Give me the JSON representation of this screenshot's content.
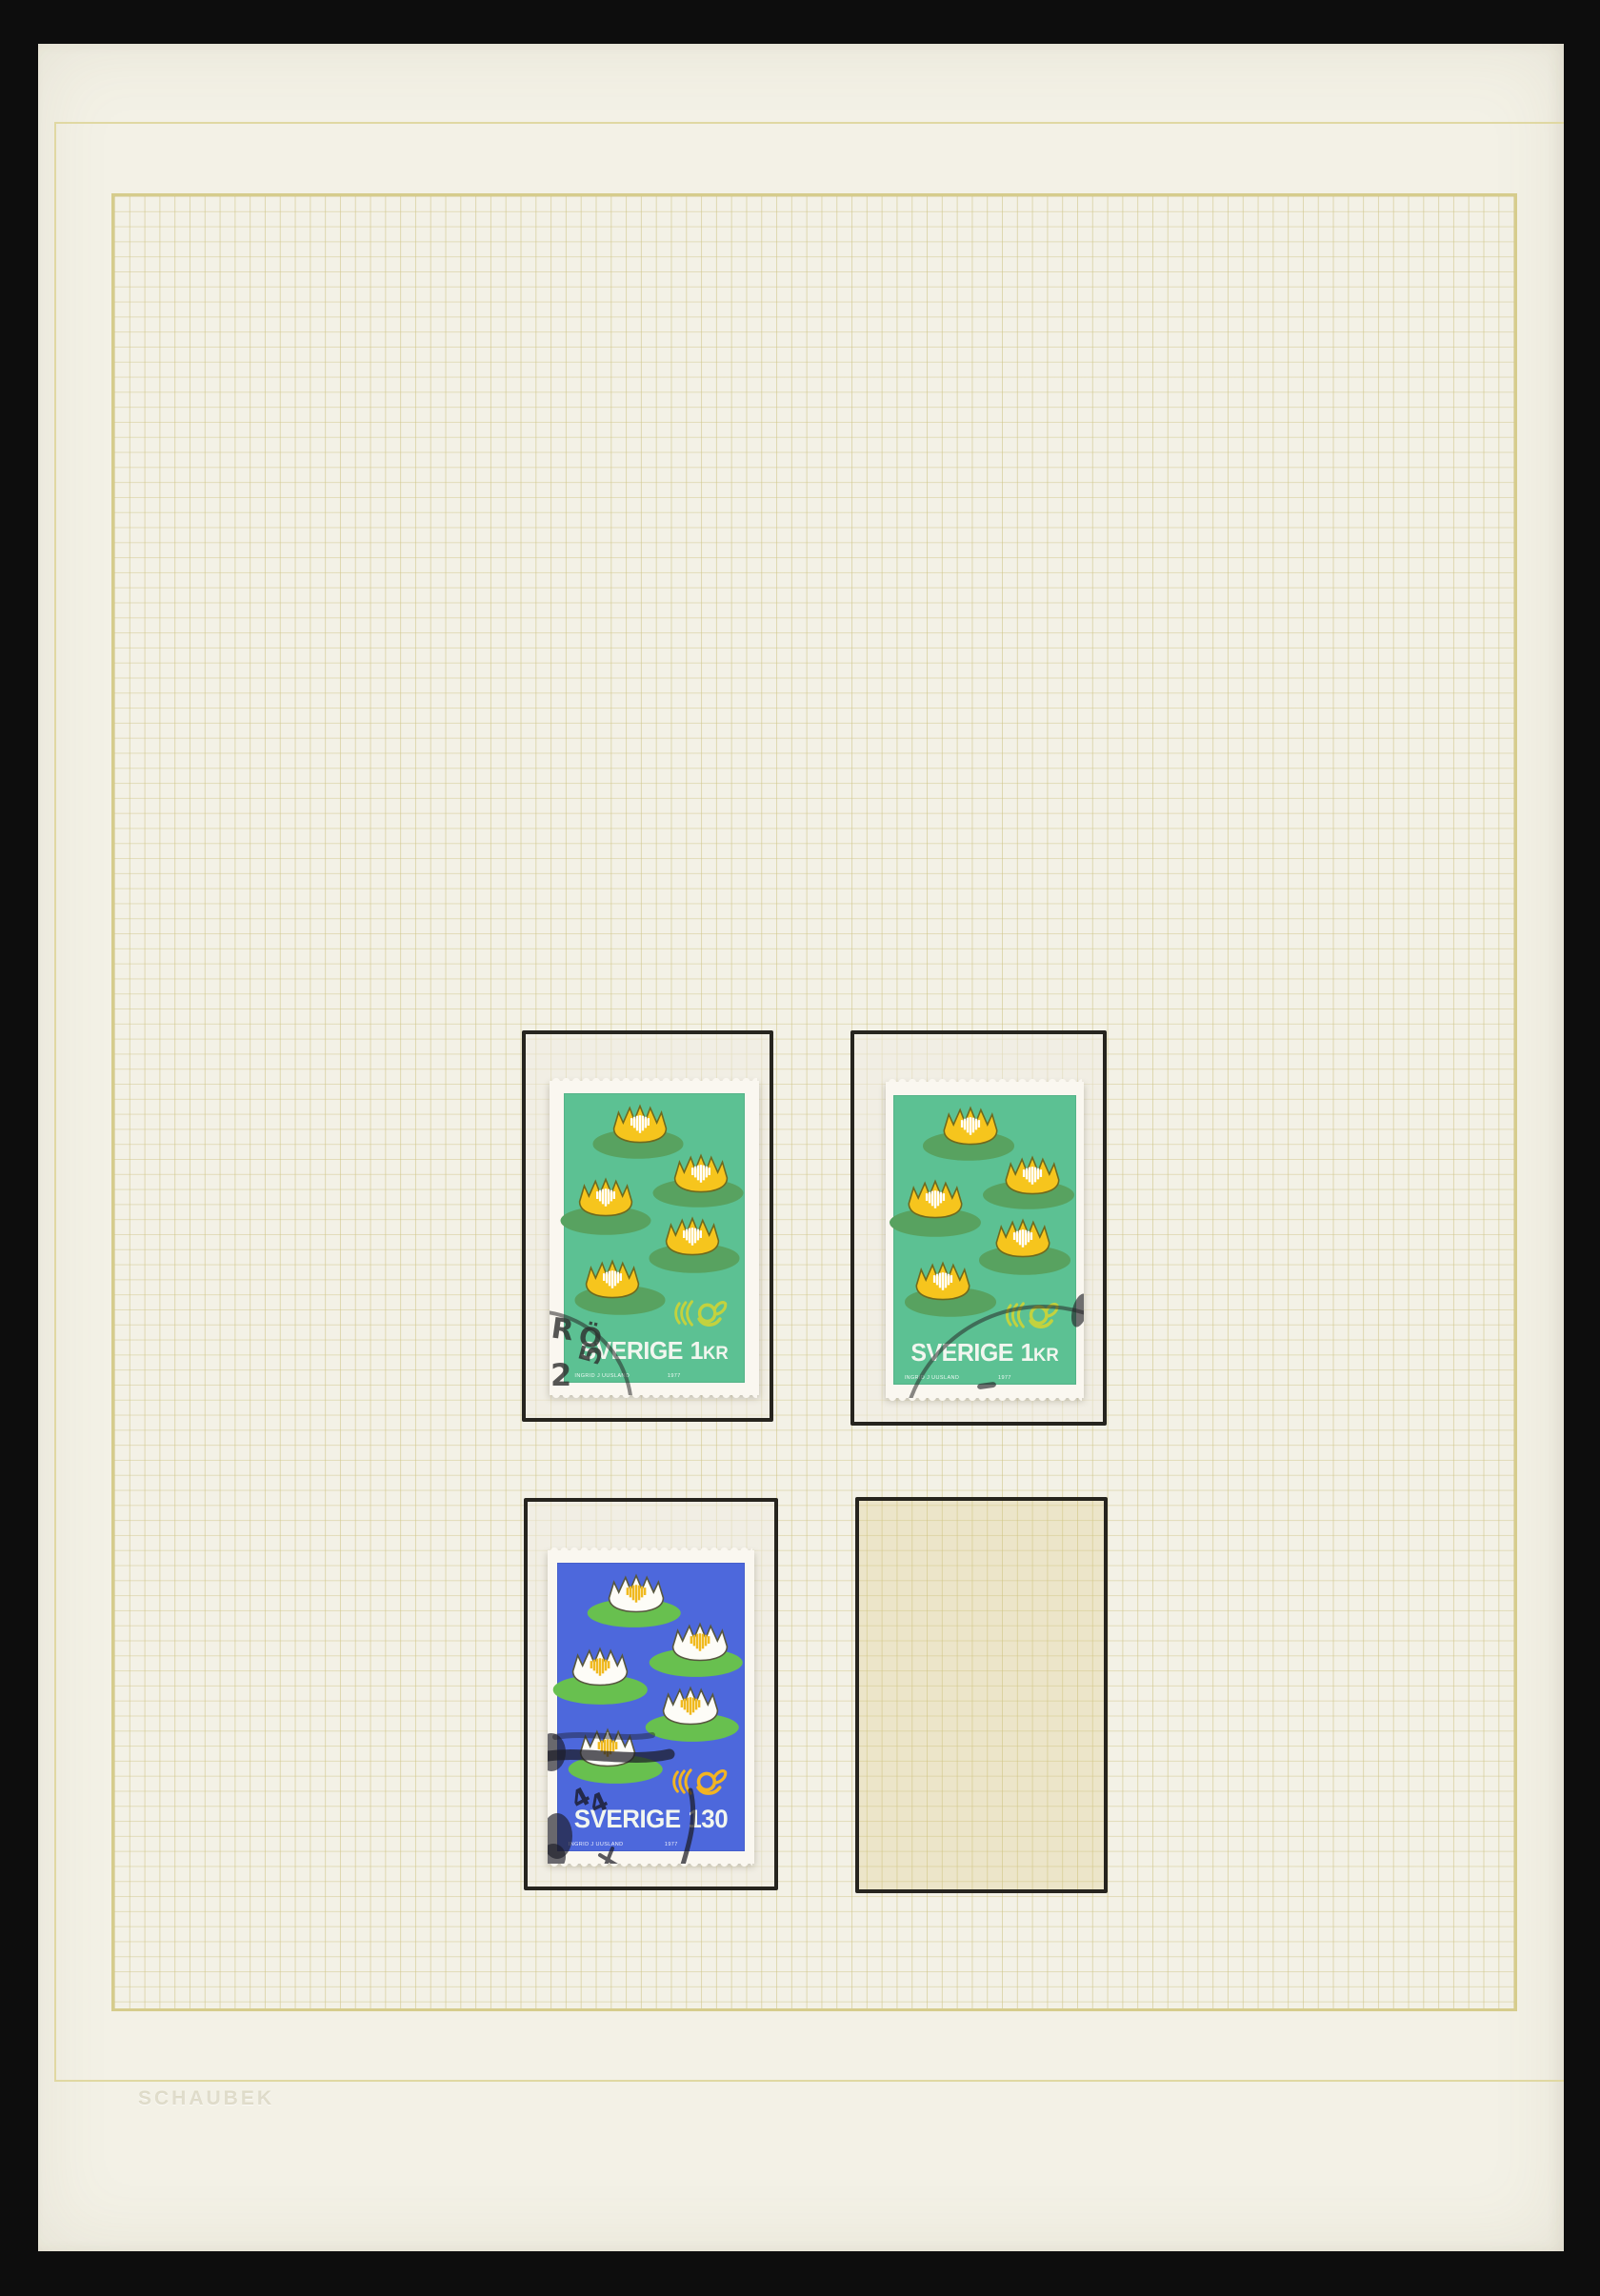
{
  "page": {
    "type": "stamp album page",
    "album_brand_emboss": "SCHAUBEK",
    "paper_color": "#f3f1e6",
    "grid_line_color": "#d6cc8c",
    "backdrop_color": "#0d0d0d",
    "mount_border_color": "#26241e"
  },
  "mounts": [
    {
      "position": "top-left",
      "occupied": true
    },
    {
      "position": "top-right",
      "occupied": true
    },
    {
      "position": "bottom-left",
      "occupied": true
    },
    {
      "position": "bottom-right",
      "occupied": false
    }
  ],
  "stamps": [
    {
      "name": "Sweden 1 KR water lilies (green, used)",
      "country": "SVERIGE",
      "denomination": "1",
      "denomination_unit": "KR",
      "background_color": "#5cc193",
      "lilypad_color": "#58a260",
      "flower_color": "#f6c51d",
      "flower_stripe_color": "#ffffff",
      "emblem": "nordic-posthorn-icon",
      "emblem_color": "#c3d23e",
      "credit": "INGRID J UUSLAND",
      "year": "1977",
      "postmark": {
        "letter1": "R",
        "letter2": "Ö",
        "digit1": "2",
        "digit2": "5"
      }
    },
    {
      "name": "Sweden 1 KR water lilies (green, used)",
      "country": "SVERIGE",
      "denomination": "1",
      "denomination_unit": "KR",
      "background_color": "#5cc193",
      "lilypad_color": "#58a260",
      "flower_color": "#f6c51d",
      "flower_stripe_color": "#ffffff",
      "emblem": "nordic-posthorn-icon",
      "emblem_color": "#c3d23e",
      "credit": "INGRID J UUSLAND",
      "year": "1977",
      "postmark": {
        "type": "arc cancellation"
      }
    },
    {
      "name": "Sweden 1.30 water lilies (blue, used)",
      "country": "SVERIGE",
      "denomination": "130",
      "denomination_unit": "",
      "background_color": "#4d68dc",
      "lilypad_color": "#68c04f",
      "flower_color": "#fdfcf7",
      "flower_stripe_color": "#f0b91e",
      "emblem": "nordic-posthorn-icon",
      "emblem_color": "#f2b423",
      "credit": "INGRID J UUSLAND",
      "year": "1977",
      "postmark": {
        "digit1": "4",
        "digit2": "4"
      }
    }
  ]
}
